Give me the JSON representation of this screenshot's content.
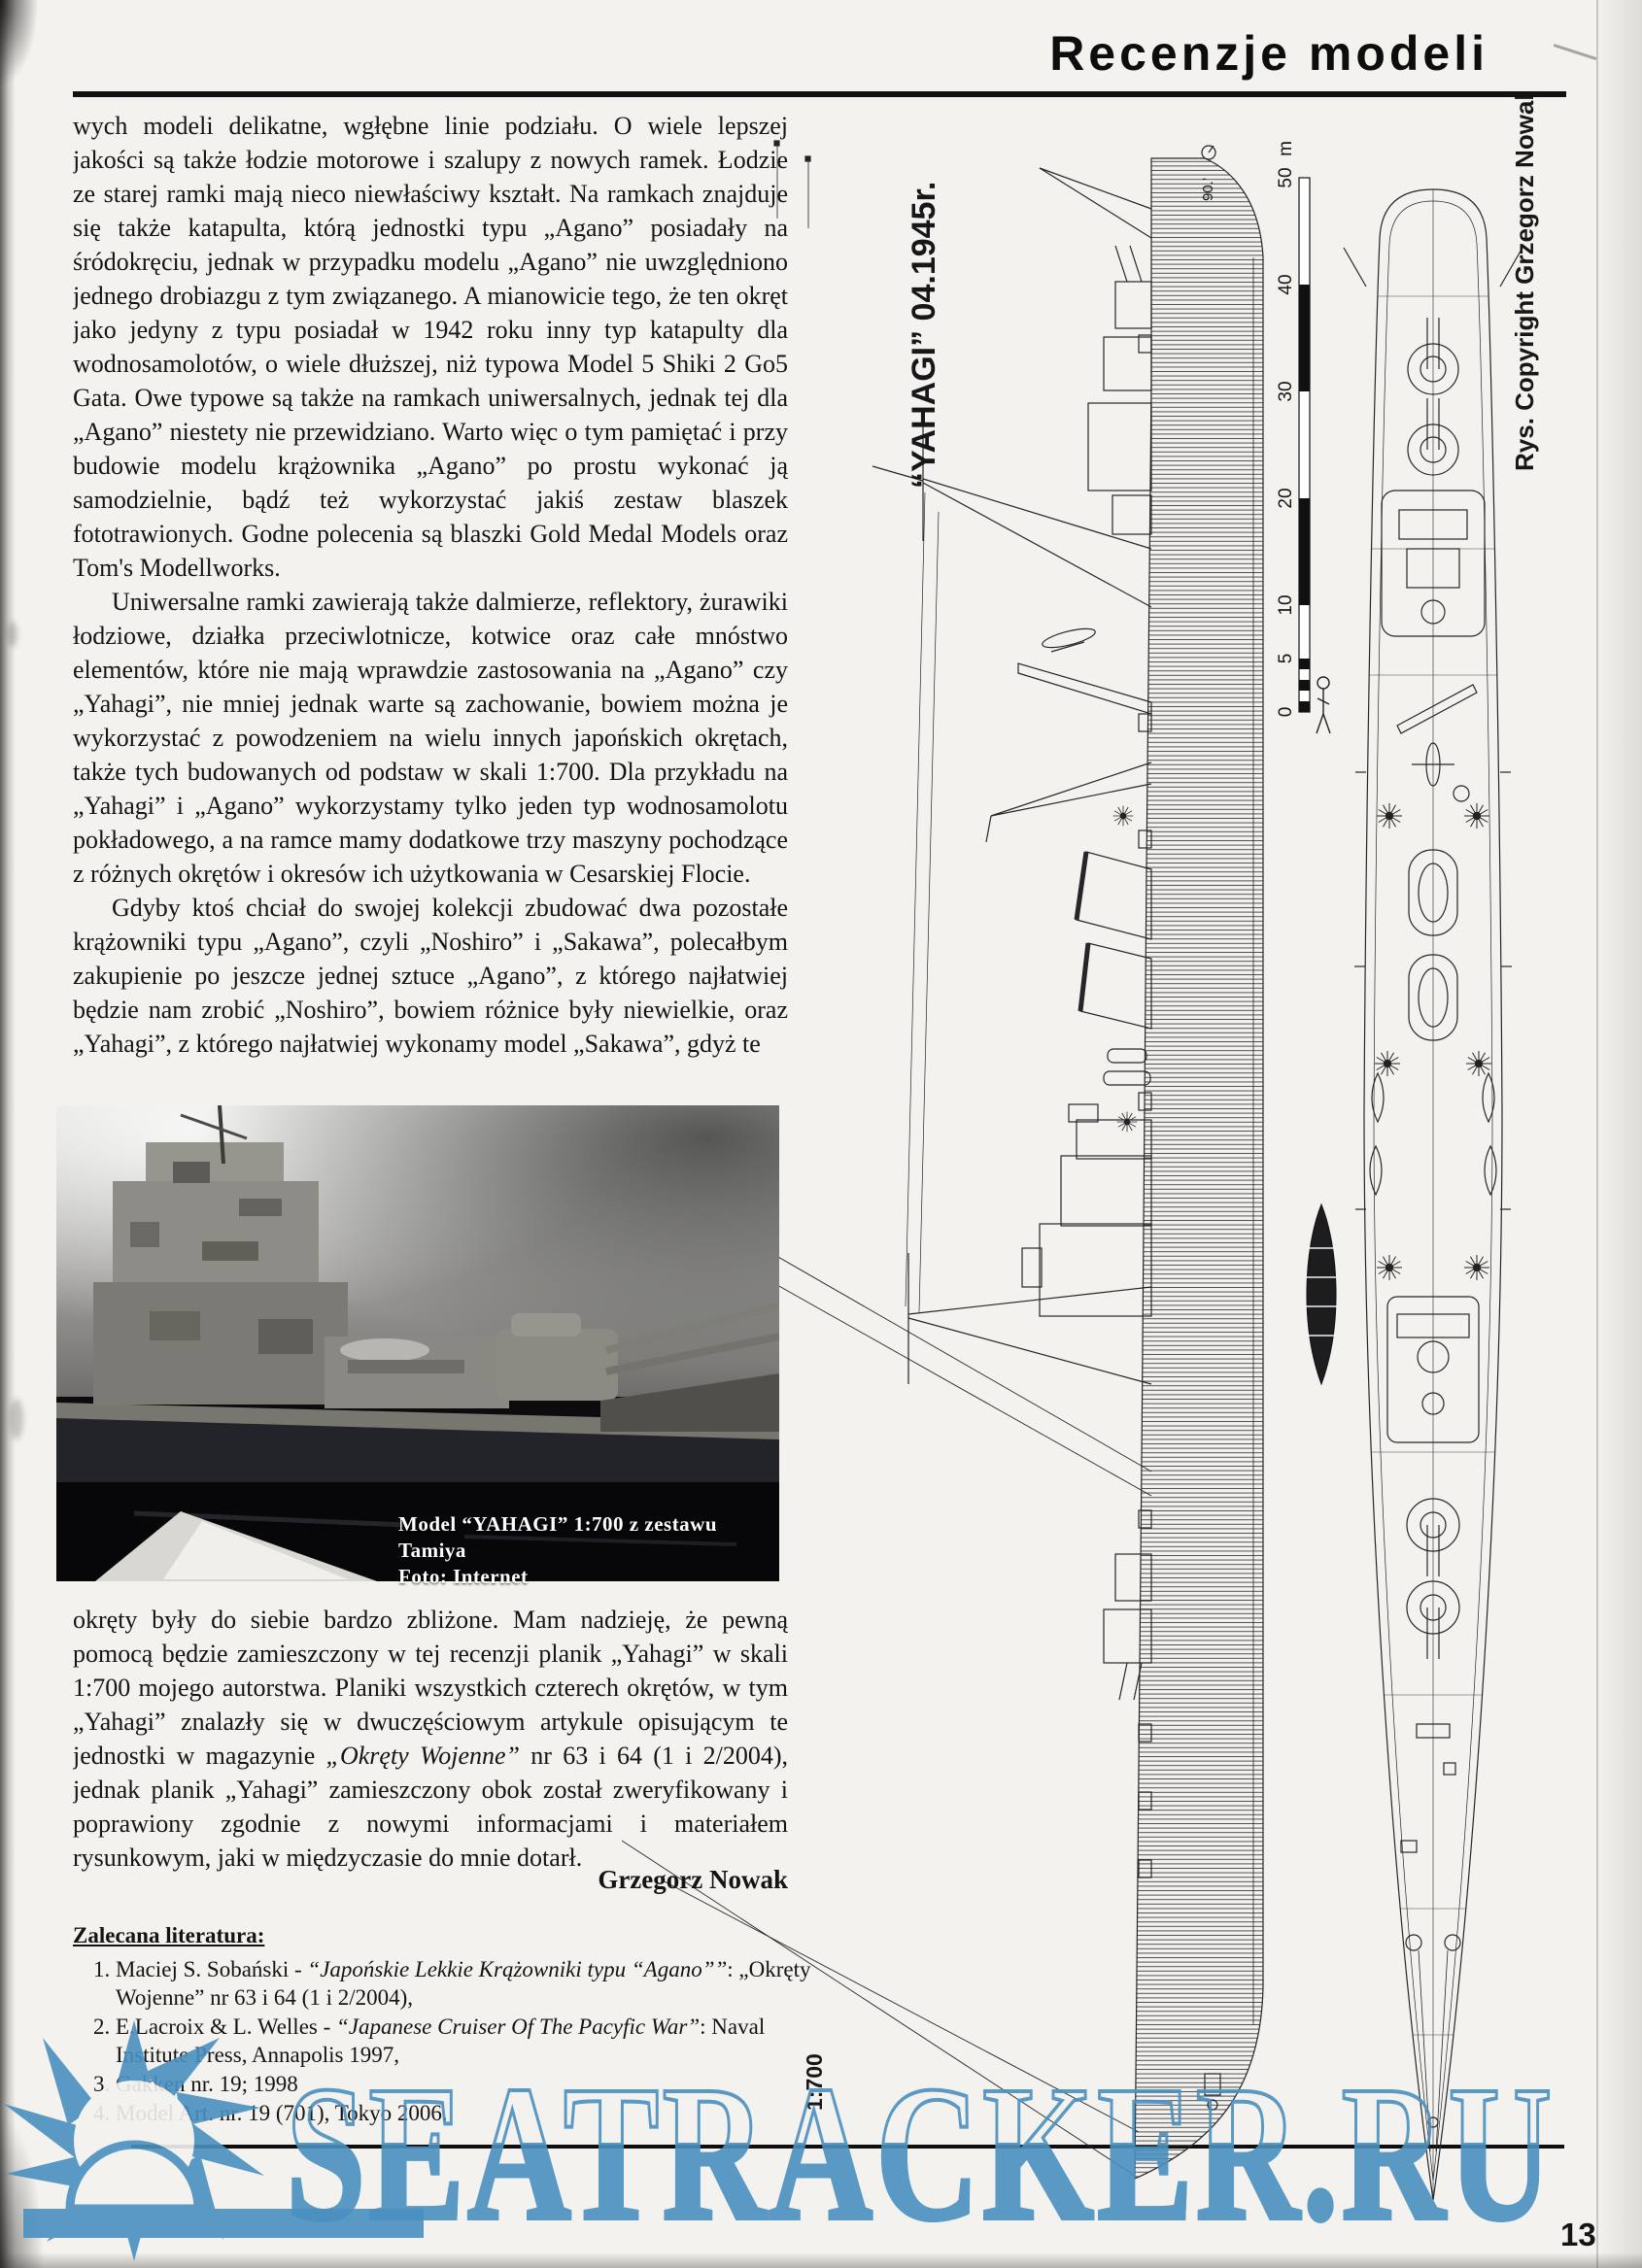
{
  "page": {
    "header": "Recenzje modeli",
    "page_number": "13"
  },
  "article": {
    "paragraphs": [
      {
        "pre": "wych modeli delikatne, wgłębne linie podziału. O wiele lepszej jakości są także łodzie motorowe i szalupy z nowych ramek. Łodzie ze starej ramki mają nieco niewłaściwy kształt. Na ramkach znajduje się także katapulta, którą jednostki typu „Agano” posiadały na śródokręciu, jednak w przypadku modelu „Agano” nie uwzględniono jednego drobiazgu z tym związanego. A mianowicie tego, że ten okręt jako jedyny z typu posiadał w 1942 roku inny typ katapulty dla wodnosamolotów, o wiele dłuższej, niż typowa Model 5 Shiki 2 Go5 Gata. Owe typowe są także na ramkach uniwersalnych, jednak tej dla „Agano” niestety nie przewidziano. Warto więc o tym pamiętać i przy budowie modelu krążownika „Agano” po prostu wykonać ją samodzielnie, bądź też wykorzystać jakiś zestaw blaszek fototrawionych. Godne polecenia są blaszki Gold Medal Models oraz Tom's Modellworks.",
        "italic": "",
        "post": ""
      },
      {
        "pre": "Uniwersalne ramki zawierają także dalmierze, reflektory, żurawiki łodziowe, działka przeciwlotnicze, kotwice oraz całe mnóstwo elementów, które nie mają wprawdzie zastosowania na „Agano” czy „Yahagi”, nie mniej jednak warte są zachowanie, bowiem można je wykorzystać z powodzeniem na wielu innych japońskich okrętach, także tych budowanych od podstaw w skali 1:700. Dla przykładu na „Yahagi” i „Agano” wykorzystamy tylko jeden typ wodnosamolotu pokładowego, a na ramce mamy dodatkowe trzy maszyny pochodzące z różnych okrętów i okresów ich użytkowania w Cesarskiej Flocie.",
        "italic": "",
        "post": ""
      },
      {
        "pre": "Gdyby ktoś chciał do swojej kolekcji zbudować dwa pozostałe krążowniki typu „Agano”, czyli „Noshiro” i „Sakawa”, polecałbym zakupienie po jeszcze jednej sztuce „Agano”, z którego najłatwiej będzie nam zrobić „Noshiro”, bowiem różnice były niewielkie, oraz „Yahagi”, z którego najłatwiej wykonamy model „Sakawa”, gdyż te",
        "italic": "",
        "post": ""
      },
      {
        "pre": "okręty były do siebie bardzo zbliżone. Mam nadzieję, że pewną pomocą będzie zamieszczony w tej recenzji planik „Yahagi” w skali 1:700 mojego autorstwa. Planiki wszystkich czterech okrętów, w tym „Yahagi” znalazły się w dwuczęściowym artykule opisującym te jednostki w magazynie ",
        "italic": "„Okręty Wojenne”",
        "post": " nr 63 i 64 (1 i 2/2004), jednak planik „Yahagi” zamieszczony obok został zweryfikowany i poprawiony zgodnie z nowymi informacjami i materiałem rysunkowym, jaki w międzyczasie do mnie dotarł."
      }
    ],
    "signature": "Grzegorz Nowak",
    "literature_heading": "Zalecana literatura:",
    "literature": [
      {
        "pre": "Maciej S. Sobański - ",
        "italic": "“Japońskie Lekkie Krążowniki typu “Agano””",
        "post": ": „Okręty Wojenne” nr 63 i 64 (1 i 2/2004),"
      },
      {
        "pre": "E.Lacroix & L. Welles - ",
        "italic": "“Japanese Cruiser Of The Pacyfic War”",
        "post": ": Naval Institute Press, Annapolis 1997,"
      },
      {
        "pre": "Gakken nr. 19; 1998",
        "italic": "",
        "post": ""
      },
      {
        "pre": "Model Art. nr. 19 (701), Tokyo 2006.",
        "italic": "",
        "post": ""
      }
    ]
  },
  "photo": {
    "caption_line1": "Model “YAHAGI” 1:700 z zestawu Tamiya",
    "caption_line2": "Foto: Internet"
  },
  "drawing": {
    "title": "“YAHAGI” 04.1945r.",
    "copyright": "Rys. Copyright Grzegorz Nowak 2004",
    "scale_label": "1:700",
    "scale_unit": "m",
    "scale_ticks": [
      "50",
      "40",
      "30",
      "20",
      "10",
      "5",
      "0"
    ],
    "angle_note": "90.’"
  },
  "watermark": {
    "text": "SEATRACKER.RU",
    "color": "#4a90c0"
  }
}
